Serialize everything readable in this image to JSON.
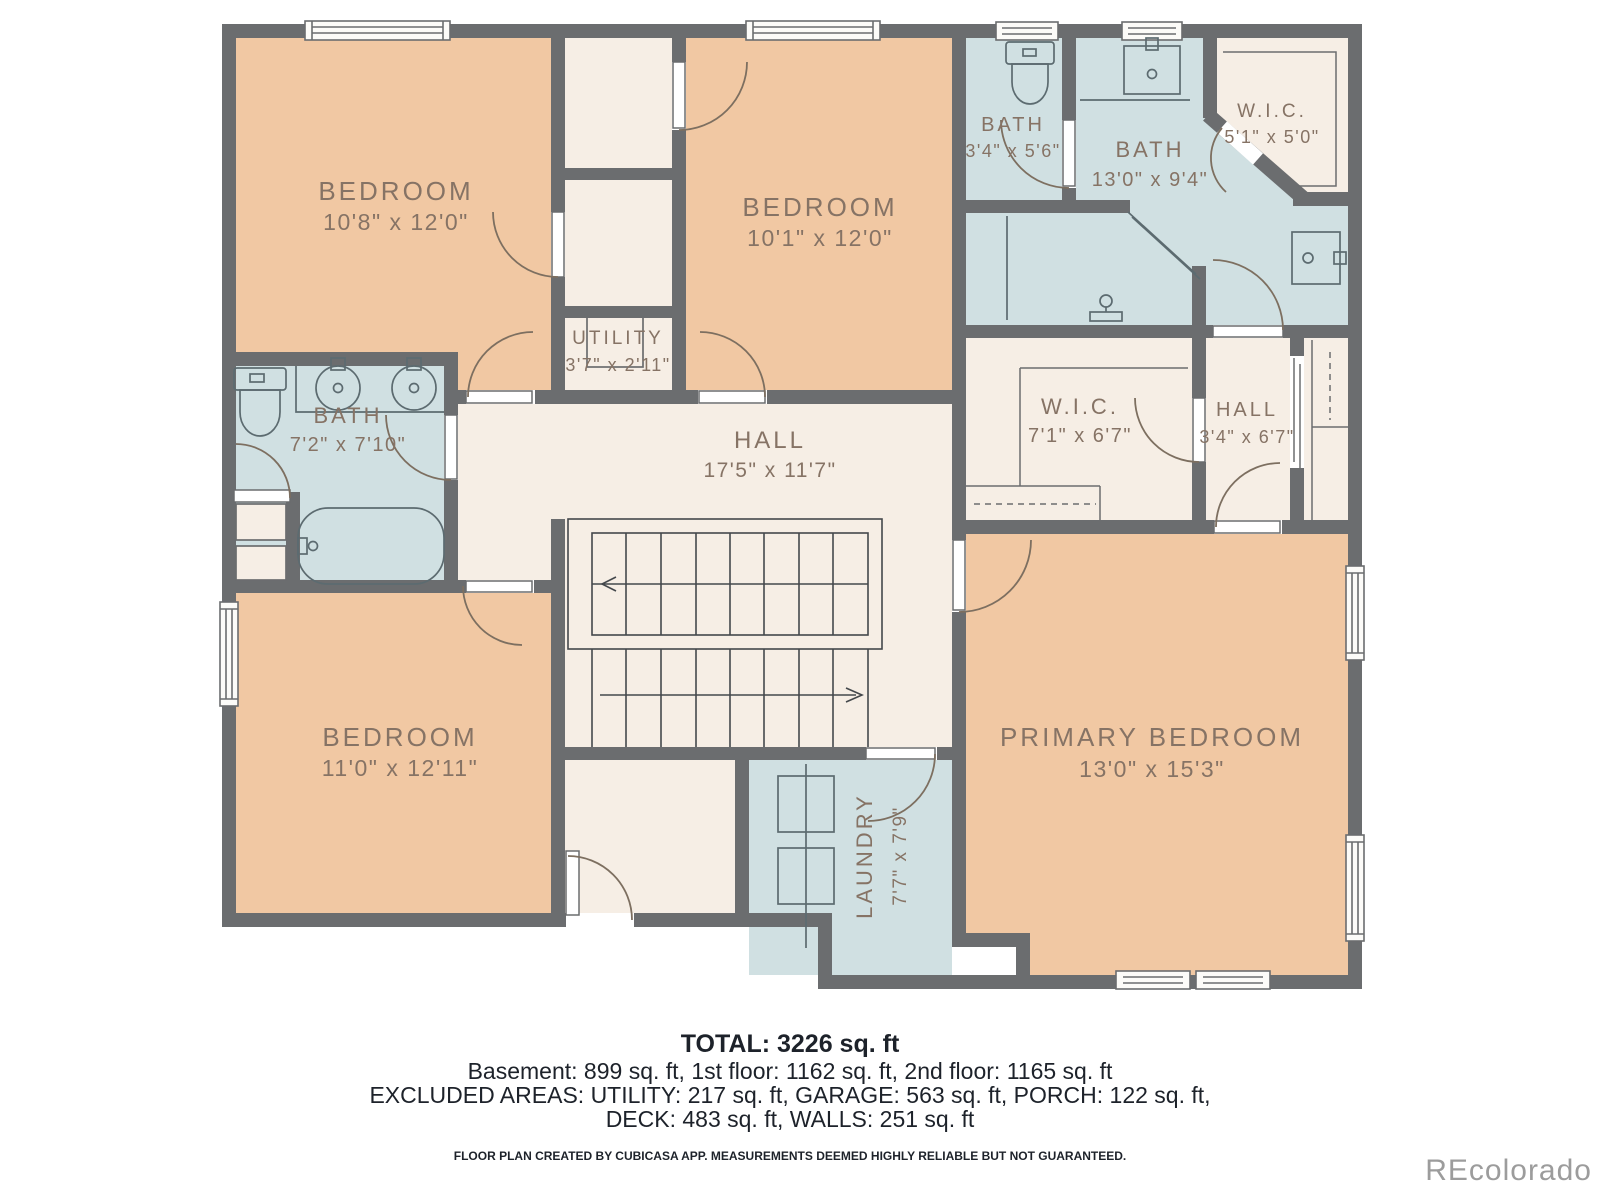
{
  "plan_title": "2nd floor plan",
  "colors": {
    "wall": "#6b6d6f",
    "bedroom_fill": "#f1c8a3",
    "bath_fill": "#d0e0e2",
    "hall_fill": "#f6eee5",
    "label_text": "#867365",
    "summary_text": "#1d222a",
    "watermark": "#9c9c9c",
    "background": "#ffffff"
  },
  "rooms": {
    "bedroom_top_left": {
      "name": "BEDROOM",
      "dims": "10'8\" x 12'0\""
    },
    "bedroom_top_middle": {
      "name": "BEDROOM",
      "dims": "10'1\" x 12'0\""
    },
    "bath_top": {
      "name": "BATH",
      "dims": "3'4\" x 5'6\""
    },
    "bath_main": {
      "name": "BATH",
      "dims": "13'0\" x 9'4\""
    },
    "wic_top": {
      "name": "W.I.C.",
      "dims": "5'1\" x 5'0\""
    },
    "utility": {
      "name": "UTILITY",
      "dims": "3'7\" x 2'11\""
    },
    "hall_main": {
      "name": "HALL",
      "dims": "17'5\" x 11'7\""
    },
    "bath_left": {
      "name": "BATH",
      "dims": "7'2\" x 7'10\""
    },
    "wic_middle": {
      "name": "W.I.C.",
      "dims": "7'1\" x 6'7\""
    },
    "hall_small": {
      "name": "HALL",
      "dims": "3'4\" x 6'7\""
    },
    "bedroom_bottom_left": {
      "name": "BEDROOM",
      "dims": "11'0\" x 12'11\""
    },
    "primary_bedroom": {
      "name": "PRIMARY BEDROOM",
      "dims": "13'0\" x 15'3\""
    },
    "laundry": {
      "name": "LAUNDRY",
      "dims": "7'7\" x 7'9\""
    }
  },
  "summary": {
    "total": "TOTAL: 3226 sq. ft",
    "line2": "Basement: 899 sq. ft, 1st floor: 1162 sq. ft, 2nd floor: 1165 sq. ft",
    "line3": "EXCLUDED AREAS: UTILITY: 217 sq. ft, GARAGE: 563 sq. ft, PORCH: 122 sq. ft,",
    "line4": "DECK: 483 sq. ft, WALLS: 251 sq. ft",
    "disclaimer": "FLOOR PLAN CREATED BY CUBICASA APP. MEASUREMENTS DEEMED HIGHLY RELIABLE BUT NOT GUARANTEED."
  },
  "watermark": "REcolorado"
}
